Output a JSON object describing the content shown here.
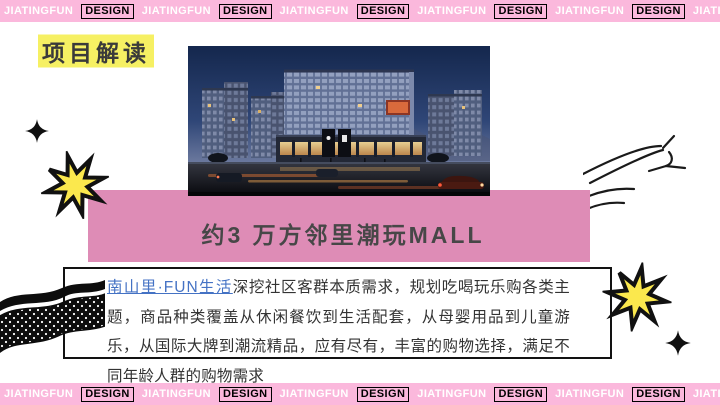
{
  "banner": {
    "white": "JIATINGFUN",
    "black": "DESIGN",
    "repeats": 7
  },
  "title": {
    "text": "项目解读"
  },
  "subtitle": {
    "text": "约3 万方邻里潮玩MALL"
  },
  "description": {
    "highlight": "南山里·FUN生活",
    "body": "深挖社区客群本质需求，规划吃喝玩乐购各类主题，商品种类覆盖从休闲餐饮到生活配套，从母婴用品到儿童游乐，从国际大牌到潮流精品，应有尽有，丰富的购物选择，满足不同年龄人群的购物需求"
  },
  "icons": [
    "sparkle-icon",
    "star-burst-icon",
    "dotted-ribbon-icon",
    "sketch-lines-icon"
  ],
  "colors": {
    "banner_pink": "#FBB8DC",
    "accent_pink": "#DE8CB6",
    "star_yellow": "#FBE84D",
    "highlight_yellow": "#F6F063",
    "link_blue": "#4472C4",
    "text_dark": "#3A3A3A"
  }
}
